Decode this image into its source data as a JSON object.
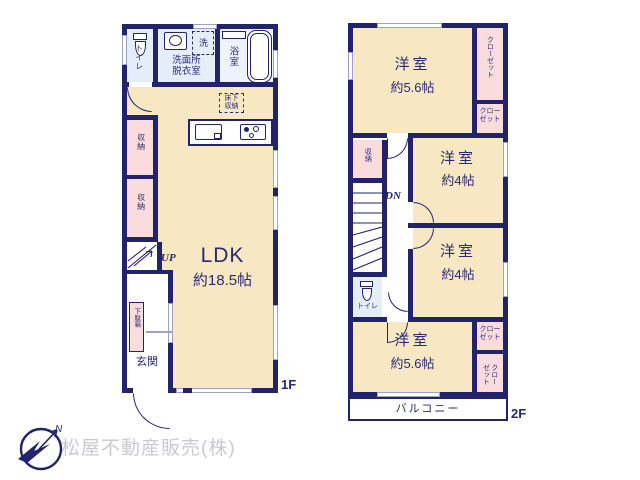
{
  "colors": {
    "wall": "#23236b",
    "room": "#f7e7c3",
    "closet": "#fadcdc",
    "wet": "#e4edf8",
    "bath": "#eef3fb",
    "text": "#2a2a72",
    "winline": "#9aa2c8",
    "muted": "#c9c9cf"
  },
  "floor1": {
    "label": "1F",
    "toilet": "トイレ",
    "washroom": "洗面所\n脱衣室",
    "laundry": "洗",
    "bath": "浴室",
    "underfloor": "床下\n収納",
    "storage_a": "収納",
    "storage_b": "収納",
    "stairs_up": "UP",
    "ldk_name": "LDK",
    "ldk_size": "約18.5帖",
    "shoe_cabinet": "下駄箱",
    "entrance": "玄関"
  },
  "floor2": {
    "label": "2F",
    "room_north_name": "洋室",
    "room_north_size": "約5.6帖",
    "closet_north_east": "クローゼット",
    "closet_north_small": "クロー\nゼット",
    "storage": "収納",
    "stairs_down": "DN",
    "room_mid_north_name": "洋室",
    "room_mid_north_size": "約4帖",
    "room_mid_south_name": "洋室",
    "room_mid_south_size": "約4帖",
    "toilet": "トイレ",
    "room_south_name": "洋室",
    "room_south_size": "約5.6帖",
    "closet_south_small": "クロー\nゼット",
    "closet_south_east": "クロー\nゼット",
    "balcony": "バルコニー"
  },
  "footer": {
    "company": "松屋不動産販売(株)",
    "north": "N"
  }
}
